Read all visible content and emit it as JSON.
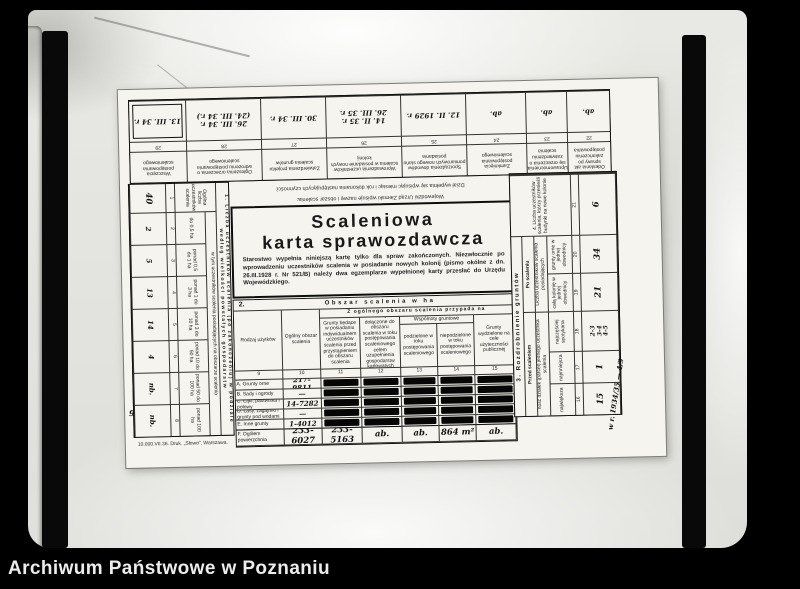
{
  "caption": "Archiwum Państwowe w Poznaniu",
  "document": {
    "title_line1": "Scaleniowa",
    "title_line2": "karta sprawozdawcza",
    "instructions": "Starostwo wypełnia niniejszą kartę tylko dla spraw zakończonych. Niezwłocznie po wprowadzeniu uczestników scalenia w posiadanie nowych kolonij (pismo okólne z dn. 26.III.1928 r. Nr 521/B) należy dwa egzemplarze wypełnionej karty przesłać do Urzędu Wojewódzkiego.",
    "upside_notes": {
      "line1": "Dział wypełnia się wpisując miesiąc i rok dokonania następujących czynności:",
      "line2": "Wojewódzki Urząd Ziemski wpisuje nazwę i obszar scalenia:"
    },
    "imprint": "10.000.VII.36.  Druk. „Słowo”, Warszawa.",
    "margin_note": "w r. 1934/35 — 4/9",
    "stray_mark": "9",
    "top_table": {
      "columns": [
        {
          "num": "22",
          "header": "Odesłania akt sprawy po zakończeniu postępowania",
          "entry": "ab."
        },
        {
          "num": "23",
          "header": "Uprawomocnienia się orzeczenia o zatwierdzeniu scalenia",
          "entry": "ab."
        },
        {
          "num": "24",
          "header": "Zamknięcia postępowania scaleniowego",
          "entry": "ab."
        },
        {
          "num": "25",
          "header": "Sporządzenia dowodów pomiarowych nowego stanu posiadania",
          "entry": "12. II. 1929 r."
        },
        {
          "num": "26",
          "header": "Wprowadzenia uczestników scalenia w posiadanie nowych kolonij",
          "entry": "14. II. 35 r.\n26. III. 35 r."
        },
        {
          "num": "27",
          "header": "Zatwierdzenia projektu scalenia gruntów",
          "entry": "30. III. 34 r."
        },
        {
          "num": "28",
          "header": "Ogłoszenia orzeczenia o wdrożeniu postępowania scaleniowego",
          "entry": "26. III. 34 r.\n(24. III. 34 r.)"
        },
        {
          "num": "29",
          "header": "Wszczęcia postępowania scaleniowego",
          "entry": "13. III. 34 r."
        }
      ]
    },
    "participants_table": {
      "title": "1.  Liczba uczestników scalenia (po zakończeniu) w podziale według wielkości powstałych gospodarstw",
      "total_label": "Ogólna liczba uczestników scalenia",
      "group_header": "w tym uczestników scalenia posiadających na obszarze scalenia",
      "groups": [
        {
          "label": "",
          "num": "1",
          "value": "40"
        },
        {
          "label": "do 0,5 ha",
          "num": "2",
          "value": "2"
        },
        {
          "label": "ponad 0,5 do 1 ha",
          "num": "3",
          "value": "5"
        },
        {
          "label": "ponad 1 do 3 ha",
          "num": "4",
          "value": "13"
        },
        {
          "label": "ponad 3 do 10 ha",
          "num": "5",
          "value": "14"
        },
        {
          "label": "ponad 10 do 50 ha",
          "num": "6",
          "value": "4"
        },
        {
          "label": "ponad 50 do 100 ha",
          "num": "7",
          "value": "nb."
        },
        {
          "label": "ponad 100 ha",
          "num": "8",
          "value": "nb."
        }
      ]
    },
    "area_table": {
      "section_num": "2.",
      "section_title": "Obszar scalenia w ha",
      "span_header": "Z ogólnego obszaru scalenia przypada na",
      "commons_header": "Wspólnoty gruntowe",
      "col_rodzaj": "Rodzaj użytków",
      "col_ogolny": "Ogólny obszar scalenia",
      "col11": "Grunty będące w posiadaniu indywidualnem uczestników scalenia przed przystąpieniem do obszaru scalenia",
      "col12": "Grunty dołączone do obszaru scalenia w toku postępowania scaleniowego celem uzupełnienia gospodarstw karłowatych",
      "col13": "podzielone w toku postępowania scaleniowego",
      "col14": "niepodzielone w toku postępowania scaleniowego",
      "col15": "Grunty wydzielone na cele użyteczności publicznej",
      "nums": [
        "9",
        "10",
        "11",
        "12",
        "13",
        "14",
        "15"
      ],
      "rows": [
        {
          "label": "A. Grunty orne",
          "total": "217-9811"
        },
        {
          "label": "B. Sady i ogrody",
          "total": "—"
        },
        {
          "label": "C. Łąki, pastwiska i połowy",
          "total": "14-7282"
        },
        {
          "label": "D. Lasy, zagajniki i grunty pod wodami",
          "total": "—"
        },
        {
          "label": "E. Inne grunty",
          "total": "1-4012"
        }
      ],
      "summary": {
        "label": "F. Ogółem powierzchnia",
        "values": [
          "233-6027",
          "233-5163",
          "ab.",
          "ab.",
          "864 m²",
          "ab."
        ]
      }
    },
    "fragmentation_table": {
      "title": "3.  Rozdrobnienie gruntów",
      "before_header": "Przed scaleniem",
      "before_sub": "Ilość działek (parcel) jednego uczestnika scalenia",
      "after_header": "Po scaleniu",
      "after_sub": "Liczba uczestników scalenia posiadających",
      "cols": [
        {
          "label": "największa",
          "num": "16",
          "value": "15"
        },
        {
          "label": "najmniejsza",
          "num": "17",
          "value": "1"
        },
        {
          "label": "najczęściej spotykana",
          "num": "18",
          "value": "2-3\n3-4\n4-5"
        },
        {
          "label": "całą kolonię w jednej obwodnicy",
          "num": "19",
          "value": "21"
        },
        {
          "label": "grunty orne w jednej obwodnicy",
          "num": "20",
          "value": "34"
        }
      ]
    },
    "buildings": {
      "label": "4. Liczba uczestników scalenia, którzy przenieśli budynki na nowe kolonie",
      "num": "21",
      "value": "6"
    }
  }
}
